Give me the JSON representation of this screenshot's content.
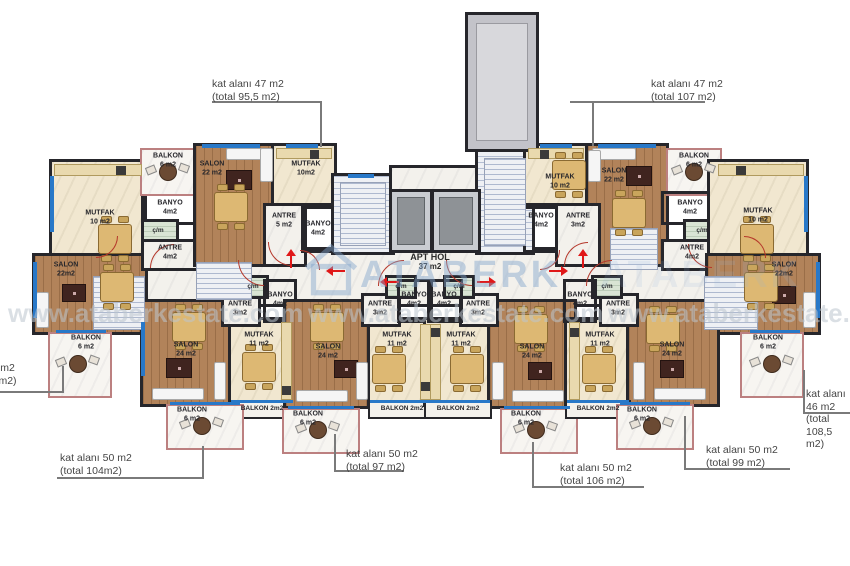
{
  "watermark": {
    "brand": "ATABERK",
    "url": "www.ataberkestate.com"
  },
  "hall": {
    "name": "APT HOL",
    "area": "37 m2"
  },
  "callouts": [
    {
      "text": "kat alanı 47 m2\n(total 95,5 m2)",
      "tx": 212,
      "ty": 78,
      "segs": [
        [
          212,
          101,
          110,
          2
        ],
        [
          320,
          101,
          2,
          46
        ]
      ]
    },
    {
      "text": "kat alanı 47 m2\n(total 107 m2)",
      "tx": 651,
      "ty": 78,
      "segs": [
        [
          570,
          101,
          135,
          2
        ],
        [
          592,
          101,
          2,
          45
        ]
      ]
    },
    {
      "text": "kat alanı 46 m2\n(total 108,5 m2)",
      "tx": -57,
      "ty": 362,
      "segs": [
        [
          0,
          391,
          63,
          2
        ],
        [
          62,
          366,
          2,
          27
        ]
      ]
    },
    {
      "text": "kat alanı 46 m2\n(total 108,5 m2)",
      "tx": 806,
      "ty": 388,
      "segs": [
        [
          803,
          370,
          2,
          44
        ],
        [
          803,
          412,
          47,
          2
        ]
      ]
    },
    {
      "text": "kat alanı 50 m2\n(total 104m2)",
      "tx": 60,
      "ty": 452,
      "segs": [
        [
          57,
          477,
          147,
          2
        ],
        [
          202,
          446,
          2,
          33
        ]
      ]
    },
    {
      "text": "kat alanı 50 m2\n(total 97 m2)",
      "tx": 346,
      "ty": 448,
      "segs": [
        [
          334,
          470,
          70,
          2
        ],
        [
          334,
          434,
          2,
          38
        ]
      ]
    },
    {
      "text": "kat alanı 50 m2\n(total 106 m2)",
      "tx": 560,
      "ty": 462,
      "segs": [
        [
          532,
          486,
          112,
          2
        ],
        [
          532,
          442,
          2,
          46
        ]
      ]
    },
    {
      "text": "kat alanı 50 m2\n(total 99 m2)",
      "tx": 706,
      "ty": 444,
      "segs": [
        [
          684,
          468,
          106,
          2
        ],
        [
          684,
          416,
          2,
          54
        ]
      ]
    }
  ],
  "floorplan": {
    "rooms": [
      {
        "n": "hall",
        "f": "hall",
        "x": 120,
        "y": 250,
        "w": 615,
        "h": 54,
        "t": null
      },
      {
        "n": "al-mutfak",
        "f": "kitchen",
        "x": 52,
        "y": 162,
        "w": 92,
        "h": 98,
        "t": "MUTFAK\n10 m2",
        "lx": 100,
        "ly": 218
      },
      {
        "n": "al-salon",
        "f": "wood",
        "x": 35,
        "y": 256,
        "w": 110,
        "h": 76,
        "t": "SALON\n22m2",
        "lx": 66,
        "ly": 270
      },
      {
        "n": "al-banyo",
        "f": "bath",
        "x": 144,
        "y": 194,
        "w": 54,
        "h": 28,
        "t": "BANYO\n4m2",
        "lx": 170,
        "ly": 208
      },
      {
        "n": "al-cm",
        "f": "closet",
        "x": 144,
        "y": 222,
        "w": 32,
        "h": 20,
        "t": "ç/m",
        "lx": 158,
        "ly": 231,
        "s": 1
      },
      {
        "n": "al-antre",
        "f": "marble",
        "x": 144,
        "y": 242,
        "w": 54,
        "h": 26,
        "t": "ANTRE\n4m2",
        "lx": 170,
        "ly": 253
      },
      {
        "n": "a1-balkon",
        "f": "balcony",
        "x": 140,
        "y": 148,
        "w": 56,
        "h": 48,
        "t": "BALKON\n6 m2",
        "lx": 168,
        "ly": 161
      },
      {
        "n": "a1-salon",
        "f": "wood",
        "x": 196,
        "y": 146,
        "w": 78,
        "h": 118,
        "t": "SALON\n22 m2",
        "lx": 212,
        "ly": 169
      },
      {
        "n": "a1-mutfak",
        "f": "kitchen",
        "x": 274,
        "y": 146,
        "w": 60,
        "h": 60,
        "t": "MUTFAK\n10m2",
        "lx": 306,
        "ly": 169
      },
      {
        "n": "a1-antre",
        "f": "marble",
        "x": 266,
        "y": 206,
        "w": 38,
        "h": 58,
        "t": "ANTRE\n5 m2",
        "lx": 284,
        "ly": 221
      },
      {
        "n": "a1-banyo",
        "f": "bath",
        "x": 304,
        "y": 206,
        "w": 30,
        "h": 44,
        "t": "BANYO\n4m2",
        "lx": 318,
        "ly": 229
      },
      {
        "n": "core-stair-left",
        "f": "stairs",
        "x": 334,
        "y": 176,
        "w": 58,
        "h": 76,
        "t": null
      },
      {
        "n": "core-lobby",
        "f": "marble",
        "x": 392,
        "y": 168,
        "w": 86,
        "h": 26,
        "t": null
      },
      {
        "n": "core-stair-right",
        "f": "stairs",
        "x": 478,
        "y": 150,
        "w": 54,
        "h": 102,
        "t": null
      },
      {
        "n": "a2-mutfak",
        "f": "kitchen",
        "x": 526,
        "y": 146,
        "w": 62,
        "h": 60,
        "t": "MUTFAK\n10 m2",
        "lx": 560,
        "ly": 182
      },
      {
        "n": "a2-salon",
        "f": "wood",
        "x": 588,
        "y": 146,
        "w": 78,
        "h": 118,
        "t": "SALON\n22 m2",
        "lx": 614,
        "ly": 176
      },
      {
        "n": "a2-banyo",
        "f": "bath",
        "x": 526,
        "y": 206,
        "w": 32,
        "h": 44,
        "t": "BANYO\n4m2",
        "lx": 541,
        "ly": 221
      },
      {
        "n": "a2-antre",
        "f": "marble",
        "x": 558,
        "y": 206,
        "w": 40,
        "h": 58,
        "t": "ANTRE\n3m2",
        "lx": 578,
        "ly": 221
      },
      {
        "n": "a2-balkon",
        "f": "balcony",
        "x": 666,
        "y": 148,
        "w": 56,
        "h": 48,
        "t": "BALKON\n6 m2",
        "lx": 694,
        "ly": 161
      },
      {
        "n": "ar-banyo",
        "f": "bath",
        "x": 664,
        "y": 194,
        "w": 54,
        "h": 28,
        "t": "BANYO\n4m2",
        "lx": 690,
        "ly": 208
      },
      {
        "n": "ar-cm",
        "f": "closet",
        "x": 686,
        "y": 222,
        "w": 32,
        "h": 20,
        "t": "ç/m",
        "lx": 702,
        "ly": 231,
        "s": 1
      },
      {
        "n": "ar-antre",
        "f": "marble",
        "x": 664,
        "y": 242,
        "w": 54,
        "h": 26,
        "t": "ANTRE\n4m2",
        "lx": 692,
        "ly": 253
      },
      {
        "n": "ar-mutfak",
        "f": "kitchen",
        "x": 710,
        "y": 162,
        "w": 96,
        "h": 98,
        "t": "MUTFAK\n10 m2",
        "lx": 758,
        "ly": 216
      },
      {
        "n": "ar-salon",
        "f": "wood",
        "x": 708,
        "y": 256,
        "w": 110,
        "h": 76,
        "t": "SALON\n22m2",
        "lx": 784,
        "ly": 270
      },
      {
        "n": "al-balkon",
        "f": "balcony",
        "x": 48,
        "y": 332,
        "w": 64,
        "h": 66,
        "t": "BALKON\n6 m2",
        "lx": 86,
        "ly": 343
      },
      {
        "n": "ar-balkon",
        "f": "balcony",
        "x": 740,
        "y": 332,
        "w": 64,
        "h": 66,
        "t": "BALKON\n6 m2",
        "lx": 768,
        "ly": 343
      },
      {
        "n": "b1-salon",
        "f": "wood",
        "x": 143,
        "y": 302,
        "w": 88,
        "h": 102,
        "t": "SALON\n24 m2",
        "lx": 186,
        "ly": 350
      },
      {
        "n": "b1-mutfak",
        "f": "kitchen",
        "x": 231,
        "y": 320,
        "w": 62,
        "h": 84,
        "t": "MUTFAK\n11 m2",
        "lx": 259,
        "ly": 340
      },
      {
        "n": "b1-antre",
        "f": "marble",
        "x": 224,
        "y": 296,
        "w": 34,
        "h": 28,
        "t": "ANTRE\n3m2",
        "lx": 240,
        "ly": 309
      },
      {
        "n": "b1-cm",
        "f": "closet",
        "x": 240,
        "y": 278,
        "w": 26,
        "h": 18,
        "t": "ç/m",
        "lx": 253,
        "ly": 287,
        "s": 1
      },
      {
        "n": "b1-banyo",
        "f": "bath",
        "x": 266,
        "y": 282,
        "w": 28,
        "h": 38,
        "t": "BANYO\n4m2",
        "lx": 280,
        "ly": 300
      },
      {
        "n": "b1-balkon2",
        "f": "bstrip",
        "x": 231,
        "y": 402,
        "w": 62,
        "h": 15,
        "t": "BALKON 2m2",
        "lx": 262,
        "ly": 409,
        "s": 1
      },
      {
        "n": "b1-balkon6",
        "f": "balcony",
        "x": 166,
        "y": 404,
        "w": 78,
        "h": 46,
        "t": "BALKON\n6 m2",
        "lx": 192,
        "ly": 415
      },
      {
        "n": "b2-salon",
        "f": "wood",
        "x": 286,
        "y": 302,
        "w": 84,
        "h": 104,
        "t": "SALON\n24 m2",
        "lx": 328,
        "ly": 352
      },
      {
        "n": "b2-mutfak",
        "f": "kitchen",
        "x": 370,
        "y": 320,
        "w": 64,
        "h": 84,
        "t": "MUTFAK\n11 m2",
        "lx": 397,
        "ly": 340
      },
      {
        "n": "b2-antre",
        "f": "marble",
        "x": 364,
        "y": 296,
        "w": 34,
        "h": 28,
        "t": "ANTRE\n3m2",
        "lx": 380,
        "ly": 309
      },
      {
        "n": "b2-cm",
        "f": "closet",
        "x": 388,
        "y": 278,
        "w": 26,
        "h": 18,
        "t": "ç/m",
        "lx": 401,
        "ly": 287,
        "s": 1
      },
      {
        "n": "b2-banyo",
        "f": "bath",
        "x": 400,
        "y": 282,
        "w": 30,
        "h": 38,
        "t": "BANYO\n4m2",
        "lx": 414,
        "ly": 300
      },
      {
        "n": "b2-balkon2",
        "f": "bstrip",
        "x": 370,
        "y": 402,
        "w": 64,
        "h": 15,
        "t": "BALKON 2m2",
        "lx": 402,
        "ly": 409,
        "s": 1
      },
      {
        "n": "b2-balkon6",
        "f": "balcony",
        "x": 282,
        "y": 408,
        "w": 78,
        "h": 46,
        "t": "BALKON\n6 m2",
        "lx": 308,
        "ly": 419
      },
      {
        "n": "b3-mutfak",
        "f": "kitchen",
        "x": 426,
        "y": 320,
        "w": 64,
        "h": 84,
        "t": "MUTFAK\n11 m2",
        "lx": 461,
        "ly": 340
      },
      {
        "n": "b3-salon",
        "f": "wood",
        "x": 490,
        "y": 302,
        "w": 84,
        "h": 104,
        "t": "SALON\n24 m2",
        "lx": 532,
        "ly": 352
      },
      {
        "n": "b3-antre",
        "f": "marble",
        "x": 462,
        "y": 296,
        "w": 34,
        "h": 28,
        "t": "ANTRE\n3m2",
        "lx": 478,
        "ly": 309
      },
      {
        "n": "b3-cm",
        "f": "closet",
        "x": 446,
        "y": 278,
        "w": 26,
        "h": 18,
        "t": "ç/m",
        "lx": 459,
        "ly": 287,
        "s": 1
      },
      {
        "n": "b3-banyo",
        "f": "bath",
        "x": 430,
        "y": 282,
        "w": 30,
        "h": 38,
        "t": "BANYO\n4m2",
        "lx": 444,
        "ly": 300
      },
      {
        "n": "b3-balkon2",
        "f": "bstrip",
        "x": 426,
        "y": 402,
        "w": 64,
        "h": 15,
        "t": "BALKON 2m2",
        "lx": 458,
        "ly": 409,
        "s": 1
      },
      {
        "n": "b3-balkon6",
        "f": "balcony",
        "x": 500,
        "y": 408,
        "w": 78,
        "h": 46,
        "t": "BALKON\n6 m2",
        "lx": 526,
        "ly": 419
      },
      {
        "n": "b4-mutfak",
        "f": "kitchen",
        "x": 567,
        "y": 320,
        "w": 62,
        "h": 84,
        "t": "MUTFAK\n11 m2",
        "lx": 600,
        "ly": 340
      },
      {
        "n": "b4-salon",
        "f": "wood",
        "x": 629,
        "y": 302,
        "w": 88,
        "h": 102,
        "t": "SALON\n24 m2",
        "lx": 672,
        "ly": 350
      },
      {
        "n": "b4-antre",
        "f": "marble",
        "x": 602,
        "y": 296,
        "w": 34,
        "h": 28,
        "t": "ANTRE\n3m2",
        "lx": 618,
        "ly": 309
      },
      {
        "n": "b4-cm",
        "f": "closet",
        "x": 594,
        "y": 278,
        "w": 26,
        "h": 18,
        "t": "ç/m",
        "lx": 607,
        "ly": 287,
        "s": 1
      },
      {
        "n": "b4-banyo",
        "f": "bath",
        "x": 566,
        "y": 282,
        "w": 28,
        "h": 38,
        "t": "BANYO\n4m2",
        "lx": 580,
        "ly": 300
      },
      {
        "n": "b4-balkon2",
        "f": "bstrip",
        "x": 567,
        "y": 402,
        "w": 62,
        "h": 15,
        "t": "BALKON 2m2",
        "lx": 598,
        "ly": 409,
        "s": 1
      },
      {
        "n": "b4-balkon6",
        "f": "balcony",
        "x": 616,
        "y": 404,
        "w": 78,
        "h": 46,
        "t": "BALKON\n6 m2",
        "lx": 642,
        "ly": 415
      }
    ],
    "shaft": {
      "x": 468,
      "y": 15,
      "w": 68,
      "h": 134
    },
    "elevators": [
      [
        392,
        192,
        38,
        58
      ],
      [
        434,
        192,
        44,
        58
      ]
    ],
    "stairs": [
      [
        93,
        276,
        52,
        54
      ],
      [
        196,
        262,
        56,
        38
      ],
      [
        610,
        228,
        48,
        42
      ],
      [
        704,
        276,
        54,
        54
      ],
      [
        340,
        182,
        46,
        64
      ],
      [
        484,
        158,
        42,
        88
      ]
    ],
    "windows": [
      [
        50,
        176,
        4,
        56
      ],
      [
        33,
        262,
        4,
        56
      ],
      [
        56,
        330,
        50,
        3
      ],
      [
        202,
        144,
        58,
        4
      ],
      [
        286,
        144,
        32,
        4
      ],
      [
        348,
        174,
        26,
        4
      ],
      [
        540,
        144,
        32,
        4
      ],
      [
        598,
        144,
        58,
        4
      ],
      [
        804,
        176,
        4,
        56
      ],
      [
        816,
        262,
        4,
        56
      ],
      [
        750,
        330,
        50,
        3
      ],
      [
        141,
        322,
        4,
        54
      ],
      [
        231,
        400,
        62,
        3
      ],
      [
        370,
        400,
        64,
        3
      ],
      [
        426,
        400,
        64,
        3
      ],
      [
        567,
        400,
        62,
        3
      ],
      [
        170,
        402,
        70,
        3
      ],
      [
        288,
        406,
        66,
        3
      ],
      [
        504,
        406,
        66,
        3
      ],
      [
        620,
        402,
        70,
        3
      ]
    ],
    "doors": [
      [
        150,
        244,
        24,
        90
      ],
      [
        268,
        242,
        24,
        0
      ],
      [
        564,
        242,
        24,
        90
      ],
      [
        688,
        244,
        24,
        0
      ],
      [
        238,
        260,
        26,
        0
      ],
      [
        378,
        260,
        26,
        90
      ],
      [
        446,
        260,
        26,
        0
      ],
      [
        586,
        260,
        26,
        90
      ],
      [
        96,
        236,
        22,
        270
      ],
      [
        744,
        236,
        22,
        180
      ],
      [
        300,
        250,
        20,
        180
      ],
      [
        540,
        250,
        20,
        270
      ]
    ],
    "arrows": [
      [
        330,
        266,
        "l"
      ],
      [
        384,
        277,
        "l"
      ],
      [
        474,
        277,
        "r"
      ],
      [
        546,
        266,
        "r"
      ],
      [
        286,
        254,
        "u"
      ],
      [
        578,
        254,
        "u"
      ]
    ],
    "tables": [
      [
        98,
        224
      ],
      [
        100,
        272
      ],
      [
        214,
        192
      ],
      [
        552,
        160
      ],
      [
        612,
        198
      ],
      [
        740,
        224
      ],
      [
        744,
        272
      ],
      [
        172,
        312
      ],
      [
        242,
        352
      ],
      [
        310,
        312
      ],
      [
        372,
        354
      ],
      [
        450,
        354
      ],
      [
        514,
        314
      ],
      [
        582,
        354
      ],
      [
        646,
        314
      ]
    ],
    "rugs": [
      [
        62,
        284,
        24,
        18
      ],
      [
        226,
        170,
        26,
        20
      ],
      [
        626,
        166,
        26,
        20
      ],
      [
        772,
        286,
        24,
        18
      ],
      [
        166,
        358,
        26,
        20
      ],
      [
        334,
        360,
        24,
        18
      ],
      [
        528,
        362,
        24,
        18
      ],
      [
        660,
        360,
        24,
        18
      ]
    ],
    "sofas": [
      [
        36,
        292,
        13,
        36
      ],
      [
        226,
        148,
        46,
        12
      ],
      [
        260,
        148,
        13,
        34
      ],
      [
        592,
        148,
        44,
        12
      ],
      [
        588,
        150,
        13,
        32
      ],
      [
        803,
        292,
        13,
        36
      ],
      [
        152,
        388,
        52,
        12
      ],
      [
        214,
        362,
        12,
        38
      ],
      [
        296,
        390,
        52,
        12
      ],
      [
        356,
        362,
        12,
        38
      ],
      [
        512,
        390,
        52,
        12
      ],
      [
        492,
        362,
        12,
        38
      ],
      [
        654,
        388,
        52,
        12
      ],
      [
        633,
        362,
        12,
        38
      ]
    ],
    "counters": [
      [
        54,
        164,
        88,
        12
      ],
      [
        276,
        148,
        56,
        11
      ],
      [
        528,
        148,
        56,
        11
      ],
      [
        718,
        164,
        86,
        12
      ],
      [
        281,
        322,
        11,
        78
      ],
      [
        420,
        324,
        11,
        76
      ],
      [
        430,
        324,
        11,
        76
      ],
      [
        569,
        322,
        11,
        78
      ]
    ],
    "stoves": [
      [
        116,
        166,
        10,
        9
      ],
      [
        310,
        150,
        9,
        9
      ],
      [
        540,
        150,
        9,
        9
      ],
      [
        736,
        166,
        10,
        9
      ],
      [
        282,
        386,
        9,
        9
      ],
      [
        421,
        382,
        9,
        9
      ],
      [
        431,
        328,
        9,
        9
      ],
      [
        570,
        328,
        9,
        9
      ]
    ],
    "round_tables": [
      [
        78,
        364
      ],
      [
        168,
        172
      ],
      [
        694,
        172
      ],
      [
        772,
        364
      ],
      [
        202,
        426
      ],
      [
        318,
        430
      ],
      [
        536,
        430
      ],
      [
        652,
        426
      ]
    ]
  }
}
